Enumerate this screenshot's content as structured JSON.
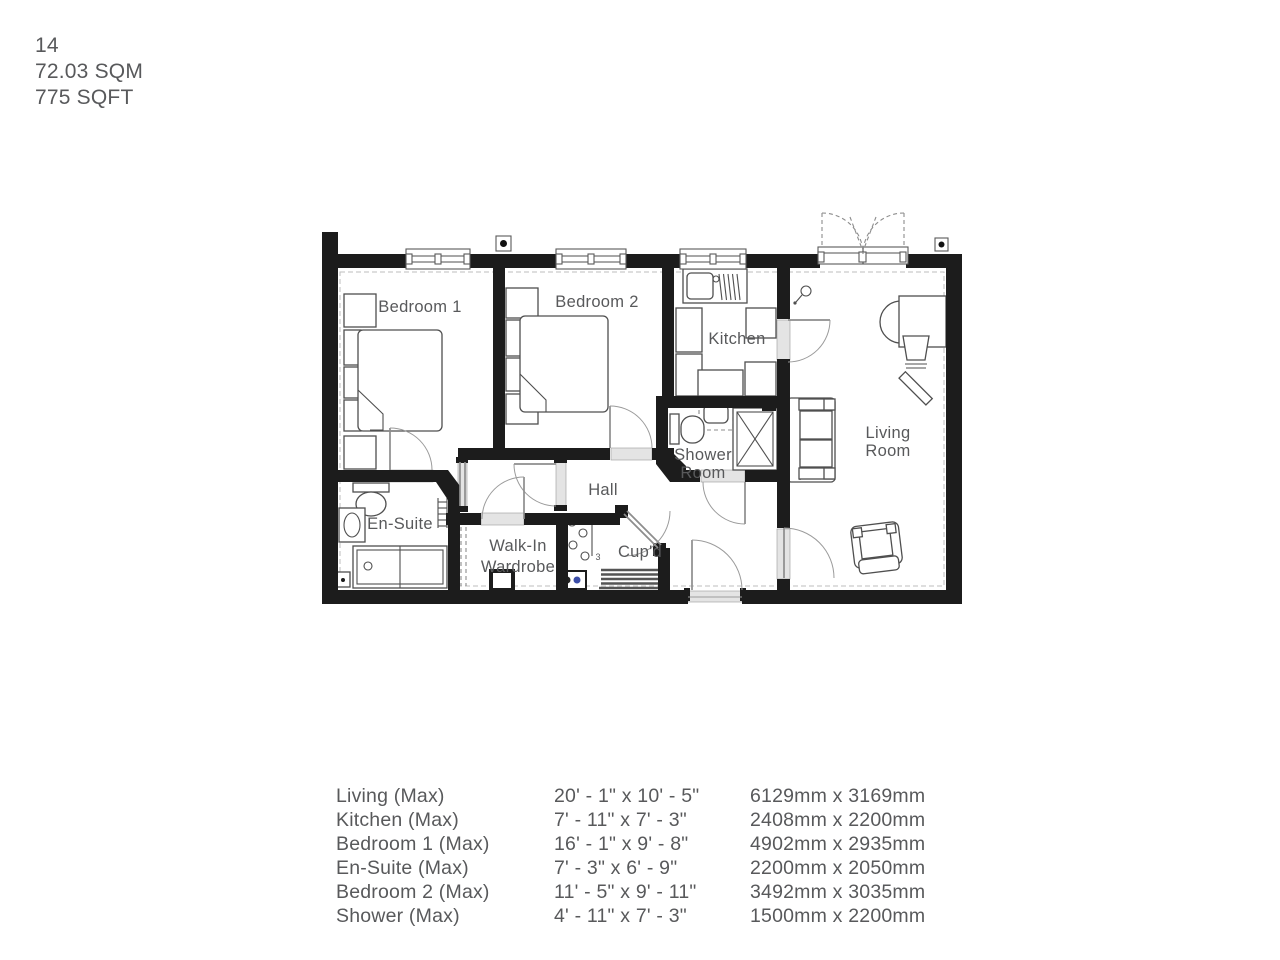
{
  "header": {
    "unit_number": "14",
    "area_sqm": "72.03 SQM",
    "area_sqft": "775 SQFT"
  },
  "plan": {
    "labels": {
      "bedroom1": "Bedroom 1",
      "bedroom2": "Bedroom 2",
      "kitchen": "Kitchen",
      "living_line1": "Living",
      "living_line2": "Room",
      "shower_line1": "Shower",
      "shower_line2": "Room",
      "hall": "Hall",
      "ensuite": "En-Suite",
      "wardrobe_line1": "Walk-In",
      "wardrobe_line2": "Wardrobe",
      "cupd": "Cup'd",
      "hook_marker": "3"
    },
    "colors": {
      "wall": "#1c1c1c",
      "text": "#58595b",
      "line": "#4f4f4f"
    }
  },
  "dimensions_table": {
    "rows": [
      {
        "room": "Living (Max)",
        "imperial": "20' - 1\" x 10' - 5\"",
        "metric": "6129mm x 3169mm"
      },
      {
        "room": "Kitchen (Max)",
        "imperial": "7' - 11\" x 7' - 3\"",
        "metric": "2408mm x 2200mm"
      },
      {
        "room": "Bedroom 1 (Max)",
        "imperial": "16' - 1\" x 9' - 8\"",
        "metric": "4902mm x 2935mm"
      },
      {
        "room": "En-Suite (Max)",
        "imperial": "7' - 3\" x 6' - 9\"",
        "metric": "2200mm x 2050mm"
      },
      {
        "room": "Bedroom 2 (Max)",
        "imperial": "11' - 5\" x 9' - 11\"",
        "metric": "3492mm x 3035mm"
      },
      {
        "room": "Shower (Max)",
        "imperial": "4' - 11\" x 7' - 3\"",
        "metric": "1500mm x 2200mm"
      }
    ]
  }
}
